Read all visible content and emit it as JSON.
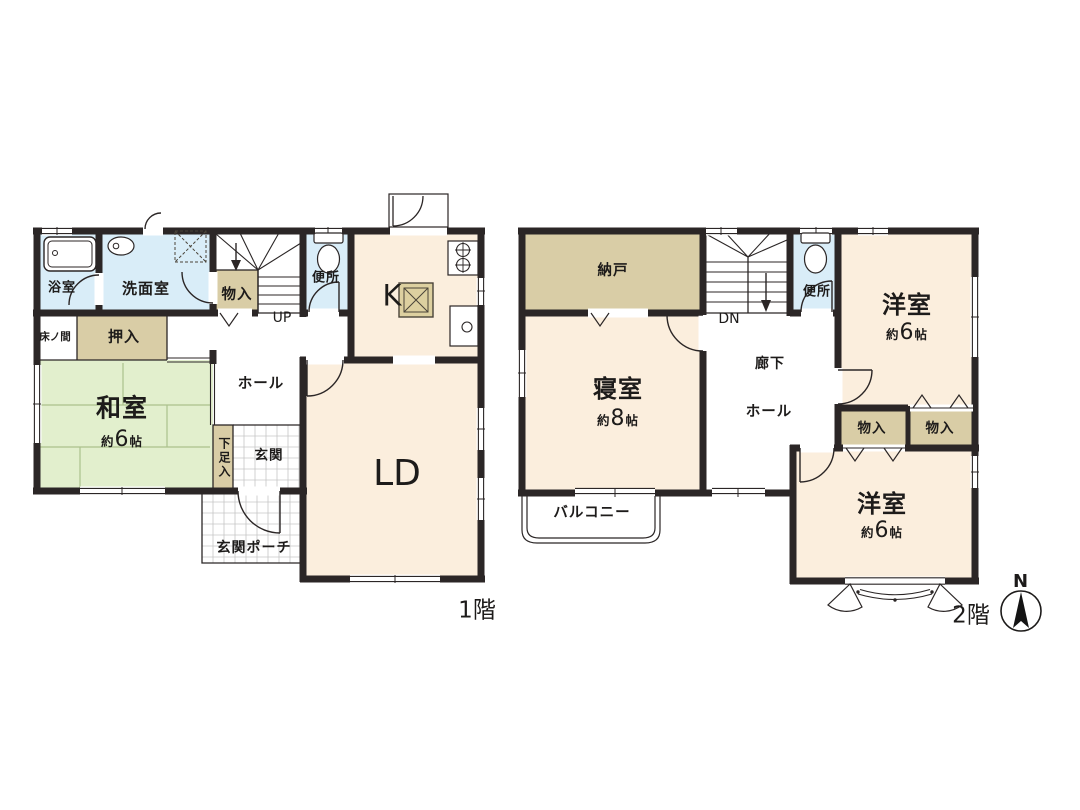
{
  "floor1": {
    "floor_label": "1階",
    "rooms": {
      "bathroom": {
        "label": "浴室"
      },
      "washroom": {
        "label": "洗面室"
      },
      "closet": {
        "label": "物入"
      },
      "toilet": {
        "label": "便所"
      },
      "stairs": {
        "label": "UP"
      },
      "kitchen": {
        "label": "K"
      },
      "tokonoma": {
        "label": "床ノ間"
      },
      "oshiire": {
        "label": "押入"
      },
      "japanese_room": {
        "label": "和室",
        "size_prefix": "約",
        "size_value": "6",
        "size_unit": "帖"
      },
      "hall": {
        "label": "ホール"
      },
      "shoe_closet": {
        "label": "下足入"
      },
      "entrance": {
        "label": "玄関"
      },
      "entrance_porch": {
        "label": "玄関ポーチ"
      },
      "living_dining": {
        "label": "LD"
      }
    }
  },
  "floor2": {
    "floor_label": "2階",
    "rooms": {
      "storage_room": {
        "label": "納戸"
      },
      "stairs": {
        "label": "DN"
      },
      "toilet": {
        "label": "便所"
      },
      "western_room_upper": {
        "label": "洋室",
        "size_prefix": "約",
        "size_value": "6",
        "size_unit": "帖"
      },
      "bedroom": {
        "label": "寝室",
        "size_prefix": "約",
        "size_value": "8",
        "size_unit": "帖"
      },
      "corridor": {
        "label": "廊下"
      },
      "hall": {
        "label": "ホール"
      },
      "closet_left": {
        "label": "物入"
      },
      "closet_right": {
        "label": "物入"
      },
      "western_room_lower": {
        "label": "洋室",
        "size_prefix": "約",
        "size_value": "6",
        "size_unit": "帖"
      },
      "balcony": {
        "label": "バルコニー"
      }
    }
  },
  "compass": {
    "north_label": "N"
  },
  "colors": {
    "wall": "#2b2626",
    "room_cream": "#fbeedd",
    "room_green": "#e2efcd",
    "room_blue": "#d9edf8",
    "room_tan": "#d9cda6",
    "tatami_line": "#abc18c",
    "tile_line": "#c6c6c6"
  }
}
